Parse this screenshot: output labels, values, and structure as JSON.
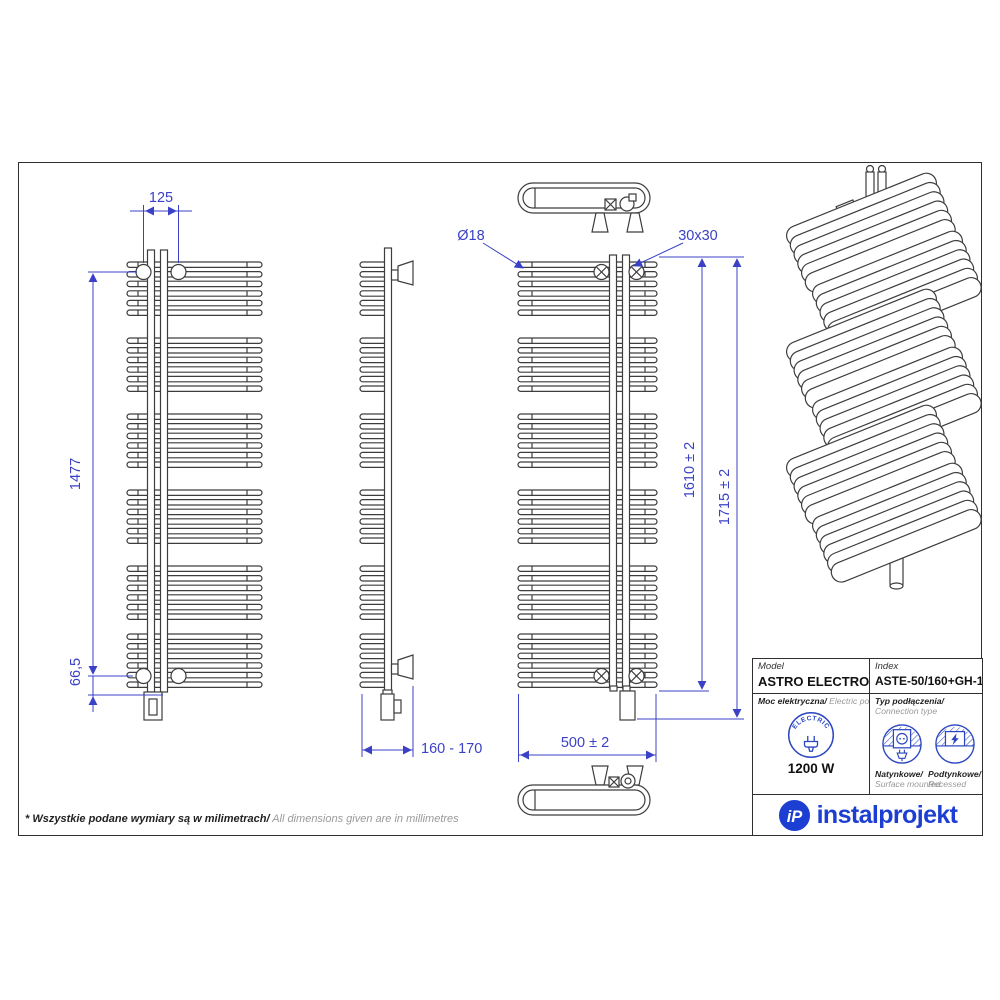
{
  "dims": {
    "pitch": "125",
    "height": "1477",
    "bottom_offset": "66,5",
    "depth_range": "160 - 170",
    "tube_diameter": "Ø18",
    "collector_profile": "30x30",
    "height_to_top": "1610 ± 2",
    "total_height": "1715 ± 2",
    "width": "500 ± 2"
  },
  "titleblock": {
    "model_label": "Model",
    "model_value": "ASTRO ELECTRO",
    "index_label": "Index",
    "index_value": "ASTE-50/160+GH-12C1",
    "power_label_pl": "Moc elektryczna/",
    "power_label_en": " Electric power",
    "electric_icon_text": "ELECTRIC",
    "power_value": "1200 W",
    "connection_label_pl": "Typ podłączenia/",
    "connection_label_en": "Connection type",
    "surface_label_pl": "Natynkowe/",
    "surface_label_en": "Surface mounted",
    "recessed_label_pl": "Podtynkowe/",
    "recessed_label_en": "Recessed",
    "brand_badge": "iP",
    "brand": "instalprojekt"
  },
  "footer": {
    "note_pl": "* Wszystkie podane wymiary są w milimetrach/",
    "note_en": " All dimensions given are in millimetres"
  },
  "colors": {
    "dimension_blue": "#3b41c6",
    "line_dark": "#3d3d3d",
    "brand_blue": "#1d3ed2"
  }
}
